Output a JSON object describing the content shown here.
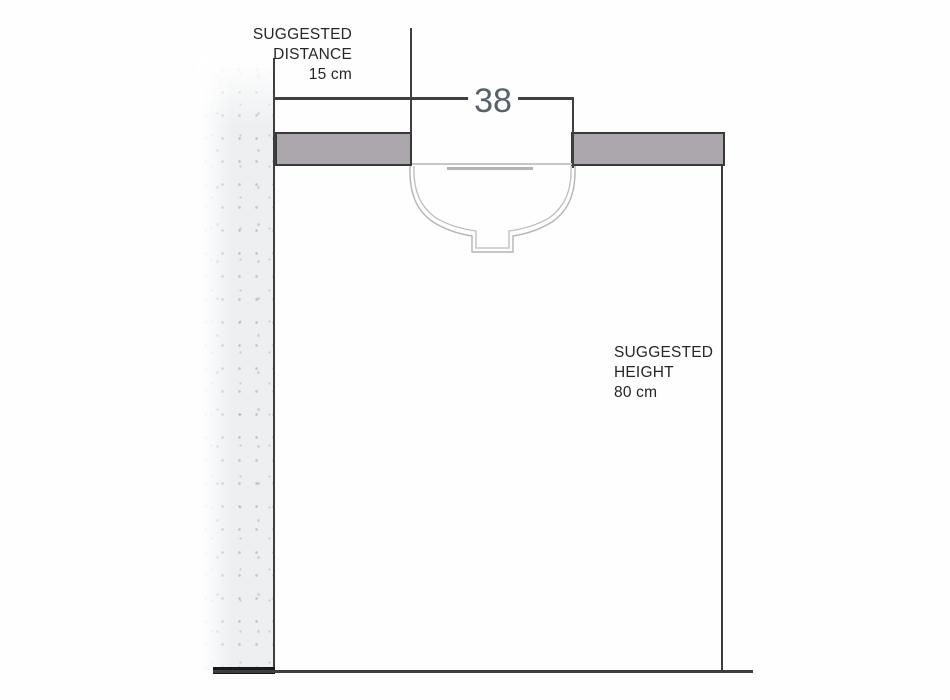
{
  "diagram": {
    "title": "washbasin installation section drawing",
    "labels": {
      "distance": {
        "line1": "SUGGESTED",
        "line2": "DISTANCE",
        "value": "15 cm"
      },
      "height": {
        "line1": "SUGGESTED",
        "line2": "HEIGHT",
        "value": "80 cm"
      }
    },
    "dimensions": {
      "basin_width": {
        "value": "38"
      },
      "wall_distance_cm": "15",
      "counter_height_cm": "80"
    },
    "elements": [
      "wall",
      "countertop",
      "undermount-basin",
      "drain",
      "floor-line"
    ],
    "colors": {
      "counter_fill": "#aba6ac",
      "line_dark": "#3e3e40",
      "dimension_text": "#57616c",
      "label_text": "#26262a",
      "basin_line": "#b4b4b6",
      "wall_base_texture": "#edeff1"
    }
  }
}
